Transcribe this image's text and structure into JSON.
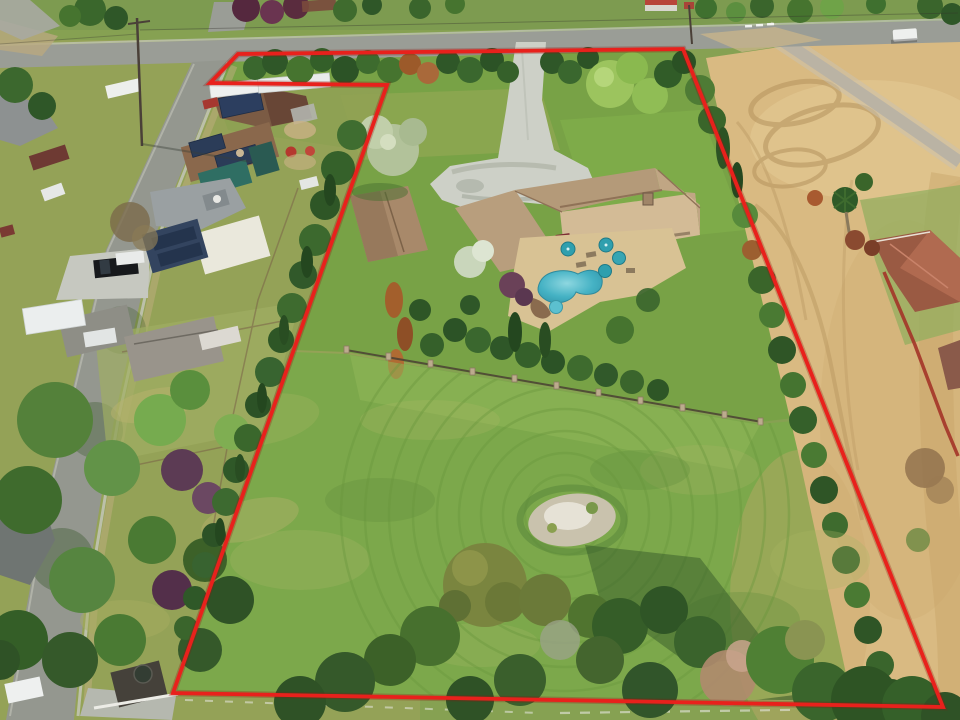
{
  "page": {
    "title": "Aerial drone photo of property with boundary outline"
  },
  "overlay": {
    "boundary_points": "238,54 683,49 943,707 173,693 387,85 210,83",
    "boundary_color": "#e8211c"
  },
  "scene": {
    "type": "aerial-drone-photo",
    "annotations": [
      "red property boundary polygon with notch at top-left corner"
    ],
    "features": [
      "paved road across the top with T-intersection and white car",
      "residential street angling to lower-left lined with single-story homes, solar roofs, RVs and parked cars",
      "subject parcel with long concrete driveway and turnaround apron",
      "tan tile-roof ranch house with rear patio, teal umbrellas and kidney-shaped pool with spa",
      "detached barn-garage left of the driveway",
      "silver-green ornamental tree beside driveway loop",
      "dense cypress and mixed tree screen along west boundary with rust-colored dead conifers",
      "iron fence with stone pillars crossing the middle of the parcel",
      "large back lawn with circular mowing rings and gray dirt patch",
      "white rail fence along the bottom boundary",
      "graded tan dirt field with tire-track swirls on the right",
      "gravel access road entering the field from the top road",
      "neighboring red tile-roof house with palm trees and red fence at lower right",
      "tree line along the bottom edge of the frame"
    ],
    "palette": {
      "lawn": "#7ca84b",
      "dry_lawn": "#aab565",
      "dirt_field": "#d9ba82",
      "asphalt": "#9a9d96",
      "concrete": "#cdd0c7",
      "roof_tan": "#c7ad8a",
      "pool_water": "#41acc0",
      "tree_dark_green": "#2f5728",
      "tree_rust": "#a35f2c",
      "boundary_red": "#e8211c"
    }
  }
}
